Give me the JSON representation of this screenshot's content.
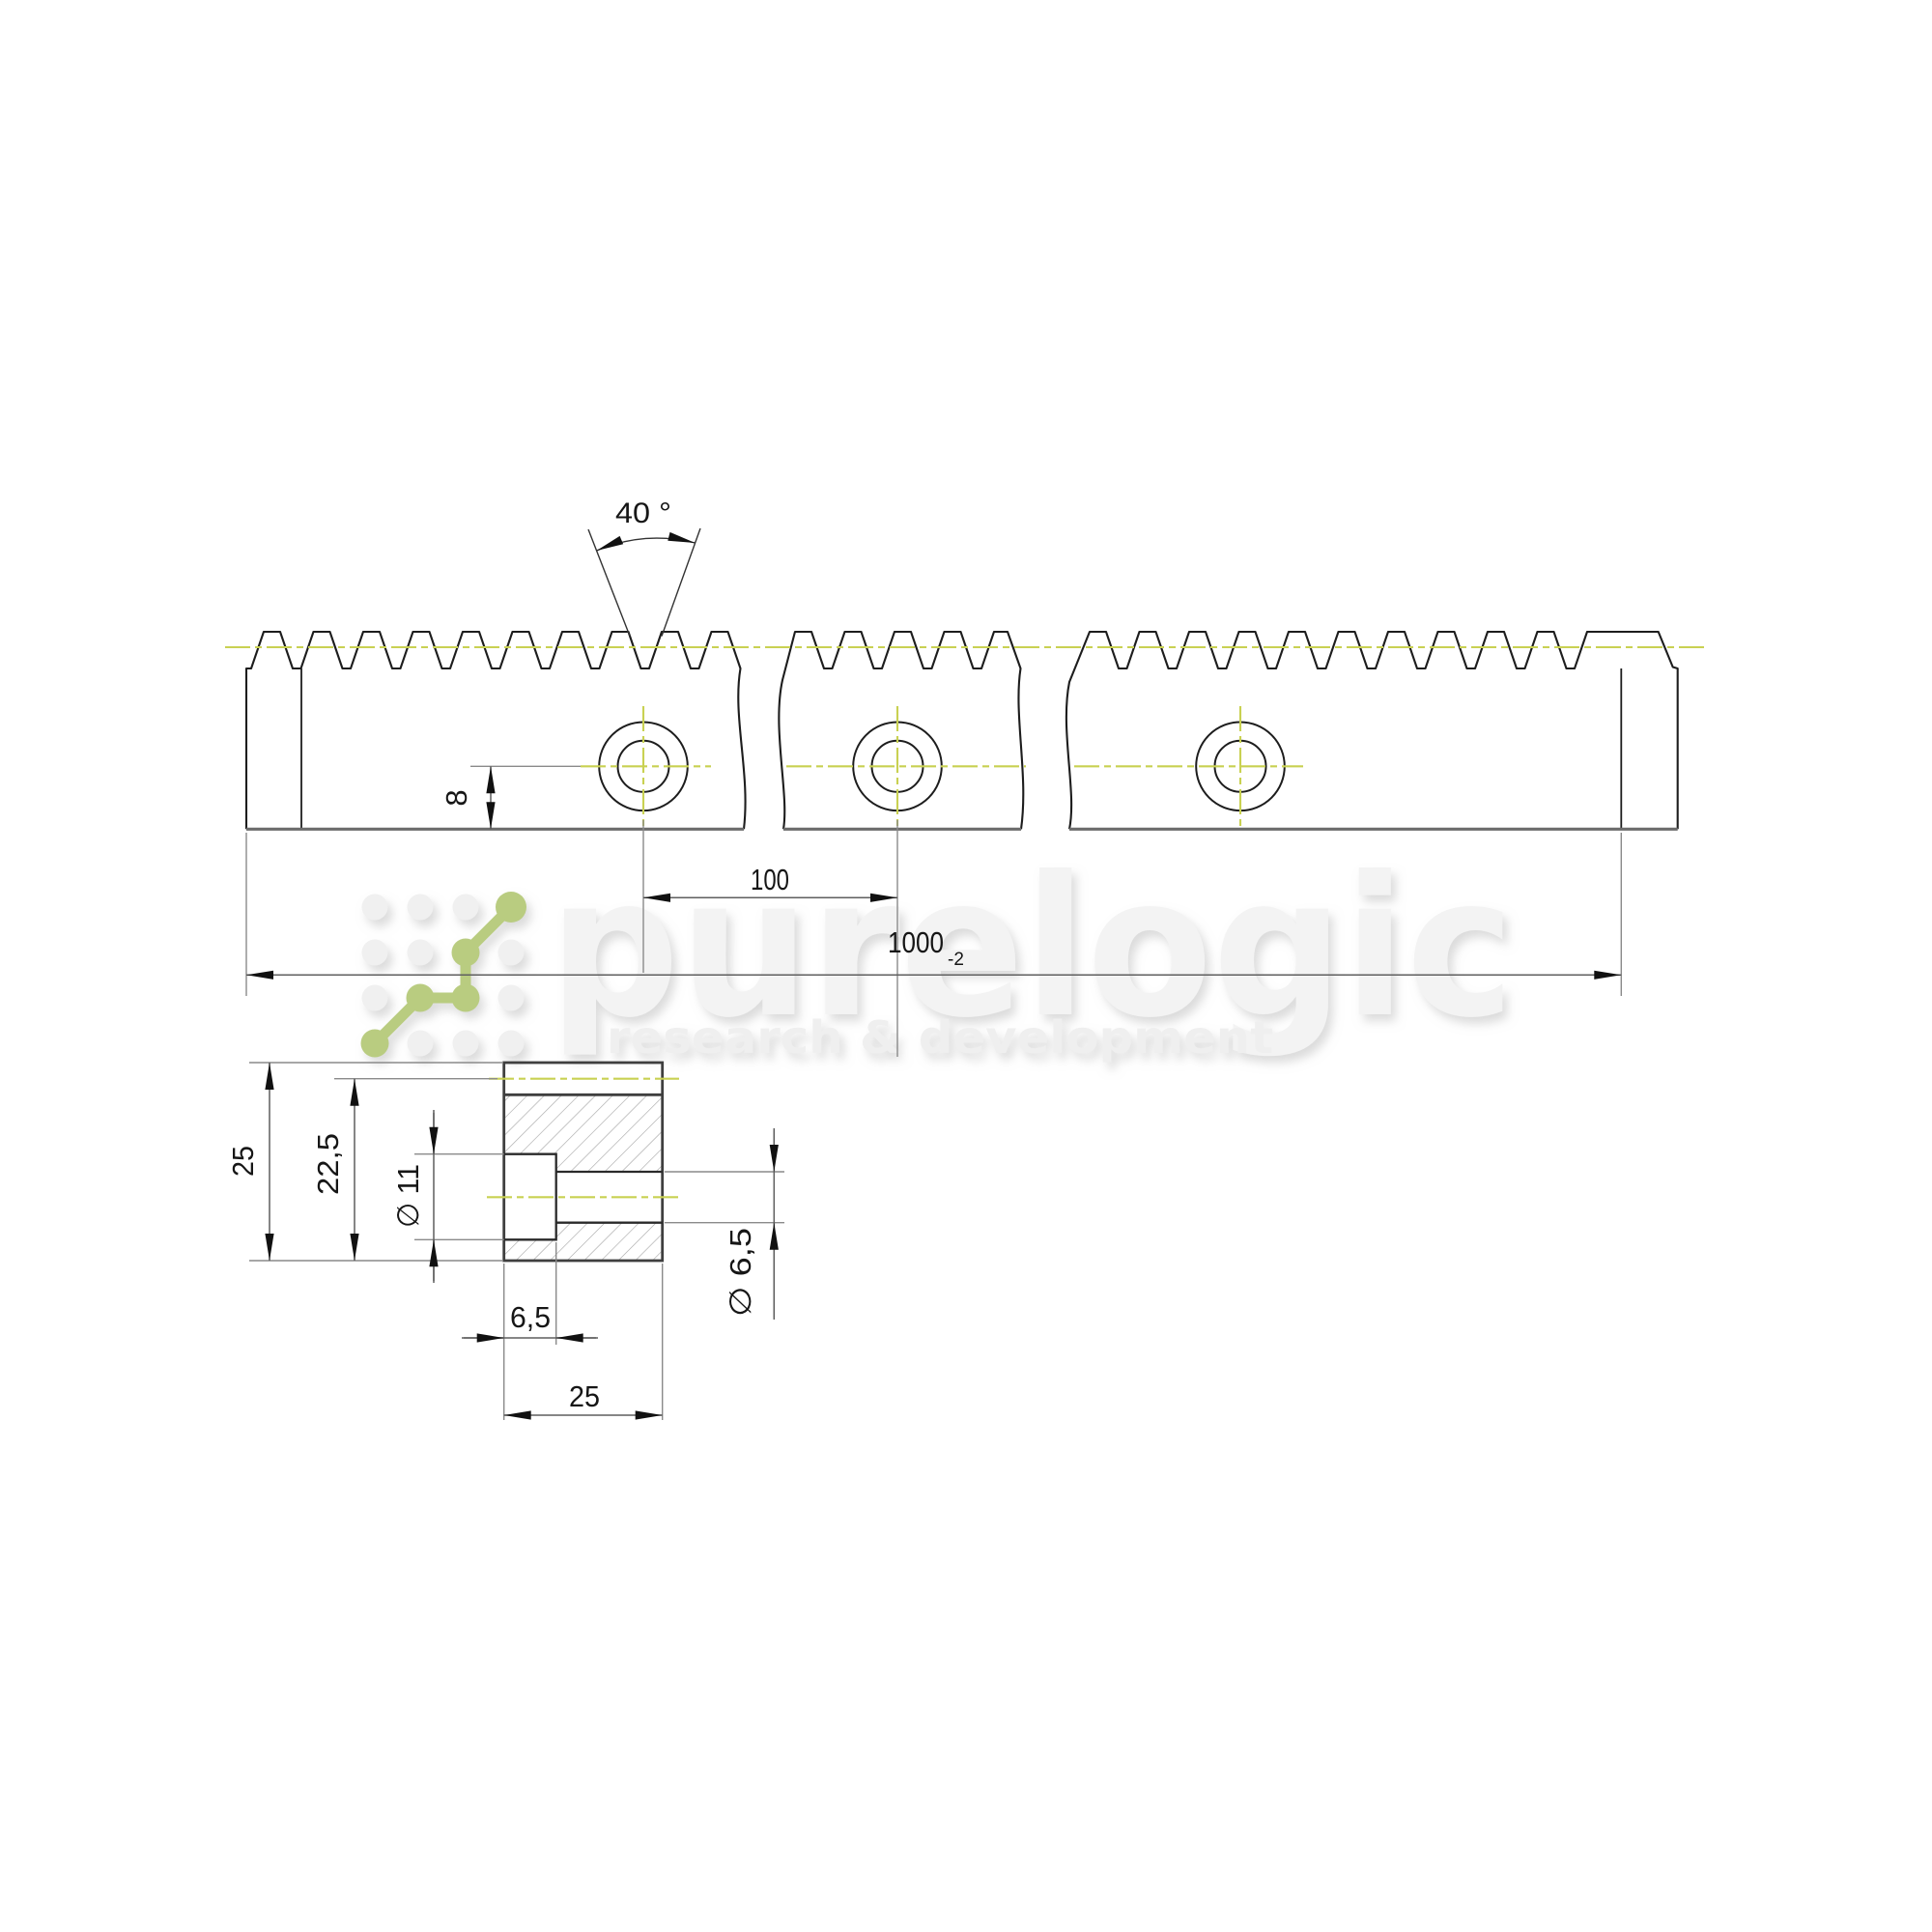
{
  "drawing": {
    "title_note": "",
    "angle": {
      "label": "40 °"
    },
    "rack_view": {
      "center_height": {
        "label": "8"
      },
      "hole_spacing": {
        "label": "100"
      },
      "overall_length": {
        "label": "1000",
        "tolerance": "-2"
      }
    },
    "section_view": {
      "height": {
        "label": "25"
      },
      "height_to_pitch": {
        "label": "22,5"
      },
      "counterbore_diameter": {
        "label": "∅ 11"
      },
      "counterbore_depth": {
        "label": "6,5"
      },
      "width": {
        "label": "25"
      },
      "through_hole_diameter": {
        "label": "∅ 6,5"
      }
    }
  },
  "watermark": {
    "brand": "purelogic",
    "tagline": "research & development"
  },
  "colors": {
    "centerline": "#c9d152",
    "logo_accent": "#b9cc80",
    "outline": "#1d1d1d",
    "auxiliary": "#8a8a8a",
    "dimension_line": "#5f5f5f",
    "section_line": "#3f3f3f",
    "bottom_edge": "#6b6b6b",
    "hatch": "#a3a3a3",
    "watermark_gray": "#f3f3f3",
    "background": "#ffffff"
  }
}
